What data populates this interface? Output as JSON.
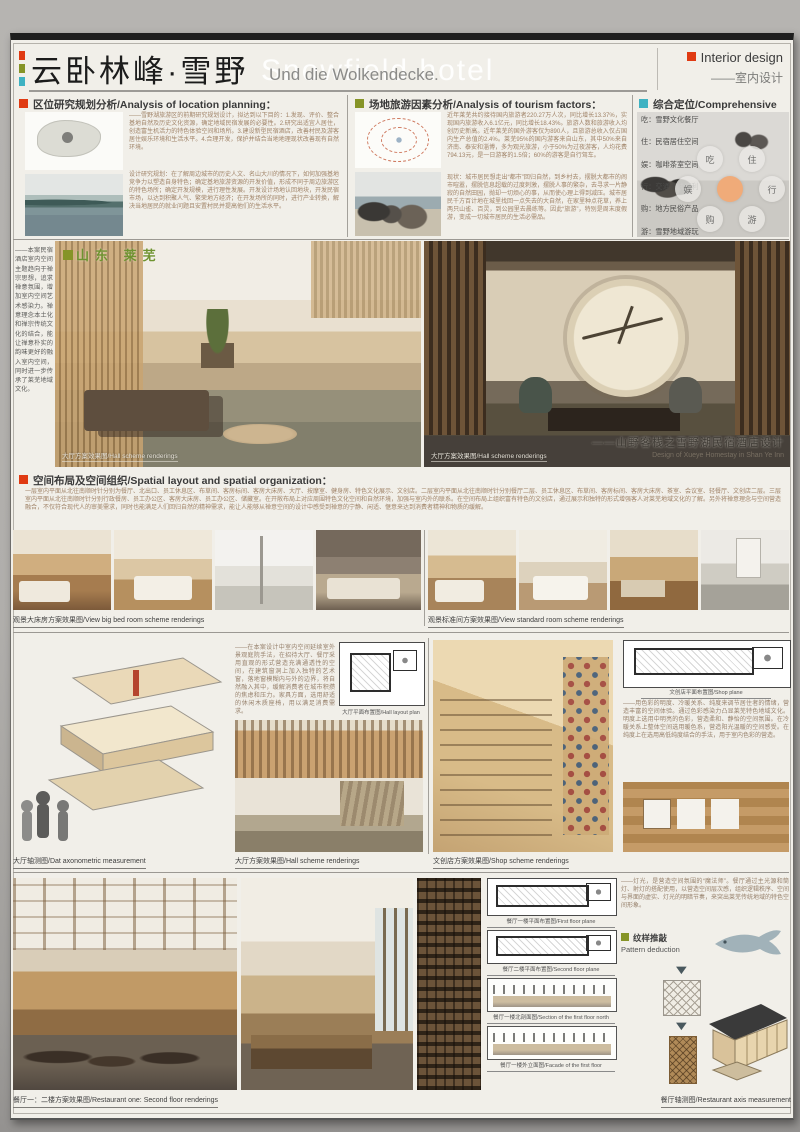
{
  "header": {
    "title_cn": "云卧林峰·雪野",
    "title_ghost": "Snowfield hotel",
    "title_de": "Und die Wolkendecke.",
    "tag_en": "Interior design",
    "tag_cn": "——室内设计"
  },
  "accent_colors": {
    "red": "#e03a12",
    "olive": "#869427",
    "cyan": "#3fb2c2",
    "orange": "#f0ab79"
  },
  "sec_location": {
    "title": "区位研究规划分析/Analysis of location planning：",
    "p1": "——雪野湖旅游区的前期研究规划设计，拟达到以下目的：1.发现、评价、整合基地自然及历史文化资源，确定地域民宿发展的必要性。2.研究出适宜人居住，创造富生机活力的特色体验空间和场所。3.建设新型民宿酒店，改善村民及游客居住娱乐环境和生活水平。4.合理开发，保护并结合当地地理现状改善现有自然环境。",
    "p2": "设计研究规划：在了解周边城市的历史人文、名山大川的情况下，如何加强基地竞争力以塑造自身特色；确定基地旅游资源的开发价值，形成不同于周边旅游区的特色场所；确定开发规模，进行理性发展。开发设计场地认回地块，开发民宿市场，以达到积聚人气、繁荣地方经济；在开发场所的同时，进行产业转换，解决当地居民的就业问题且安置村民并提高他们的生活水平。"
  },
  "sec_tourism": {
    "title": "场地旅游因素分析/Analysis of tourism factors：",
    "p1": "近年莱芜共约接待国内旅游者220.27万人次，同比增长13.37%，实现国内旅游收入6.1亿元，同比增长18.43%。旅游人数和旅游收入均创历史新高。近年莱芜的国外游客仅为890人，且旅游总收入仅占国内生产总值的2.4%。莱芜95%的国内游客来自山东，其中50%来自济南、泰安和淄博，多为观光旅游，小于50%为过夜游客，人均花费794.13元，是一日游客的1.5倍；60%的游客是自行驾车。",
    "p2": "现状：城市居民想走出“都市”回归自然，到乡村去，摆脱大都市的闹市喧嚣，摆脱信息超载的过度刺激，摆脱人事的繁杂，去寻求一片静寂的自然田园，抛却一切烦心的事，从而使心理上得到减压。城市居民千方百计地在城里找回一点失去的大自然，在家里种点花草，养上两只山雀、百灵，到公园里去晨练等。因此“旅游”，特别是周末度假游，变成一切城市居民的生活必需品。"
  },
  "sec_comprehensive": {
    "title": "综合定位/Comprehensive",
    "items": [
      "吃：雪野文化餐厅",
      "住：民宿居住空间",
      "娱：咖啡茶室空间",
      "行：交通流线便利",
      "购：地方民俗产品",
      "游：雪野地域游玩"
    ],
    "circles": [
      "吃",
      "住",
      "娱",
      "行",
      "购",
      "游"
    ]
  },
  "hero": {
    "side_note": "——本案民宿酒店室内空间主题趋向于禅宗思想，追求禅意氛围，增加室内空间艺术感染力。禅意理念本土化和禅宗传统文化的结合，能让禅意朴实的韵味更好的融入室内空间，同时进一步传承了莱芜地域文化。",
    "region_label": "山东 莱芜",
    "caption_left": "大厅方案效果图/Hall scheme renderings",
    "caption_right": "大厅方案效果图/Hall scheme renderings",
    "project_cn": "——山野客栈之雪野湖民宿酒店设计",
    "project_en": "Design of Xueye Homestay in Shan Ye Inn"
  },
  "sec_spatial": {
    "title": "空间布局及空间组织/Spatial layout and spatial organization：",
    "p1": "一层室内平面从北往南顺时针分别为餐厅、北出口、员工休息区、布草间、客房标间、客房大床房、大厅、按摩室、健身房、特色文化展示、文创店。二层室内平面从北往南顺时针分别餐厅二层、员工休息区、布草间、客房标间、客房大床房、茶室、会议室、轻餐厅、文创店二层。三层室内平面从北往南顺时针分别行政餐房、员工办公区、客房大床房、员工办公区、储藏室。在开敞布局上对应周围特色文化空间和自然环境，加强与室内外的联系。在空间布局上组织富有特色的文创店，通过展示和独特的形式增强客人对莱芜地域文化的了解。另外将禅意理念与空间营造融合，不仅符合现代人的审美需求，同时也能满足人们回归自然的精神需求，能让人能够从禅意空间的设计中感受到禅意的宁静、闲适、惬意来达到消费者精神和物质的缓解。"
  },
  "rooms": {
    "caption_left": "观景大床房方案效果图/View big bed room scheme renderings",
    "caption_right": "观景标准间方案效果图/View standard room scheme renderings"
  },
  "row3": {
    "axon_caption": "大厅轴测图/Dat axonometric measurement",
    "mid_text": "——在本案设计中室内空间延续室外景观庭院手法，在招待大厅、餐厅采用直观的形式营造充满通透性的空间，在建筑窗洞上加入独特的艺术窗，落地窗模糊内与外的边界，将自然融入其中，缓解消费者在城市积攒的焦虑和压力。家具方面，选用舒适的休闲木质座椅，用以满足消费需求。",
    "hall_plan_caption": "大厅平面布置图/Hall layout plan",
    "hall_caption": "大厅方案效果图/Hall scheme renderings",
    "shop_caption": "文创店方案效果图/Shop scheme renderings",
    "shop_plan_caption": "文创店平面布置图/Shop plane",
    "color_text": "——用色彩的明度、冷暖关系、纯度来调节居住者的情绪，营造丰富的空间体验。通过色彩感染力凸显莱芜特色地域文化。明度上选用中明亮的色彩，营造柔和、静怡的空间氛围。在冷暖关系上整体空间选用暖色系，营造阳光温暖的空间感受。在纯度上在选用高低纯度结合的手法，用于室内色彩的营造。"
  },
  "row4": {
    "light_text": "——灯光，是营造空间氛围的“魔法师”。餐厅通过主光源和筒灯、射灯的搭配使用，以营造空间层次感，组织逻辑秩序、空间与界面的虚实、灯光的明暗节奏，来突出莱芜传统地域的特色空间形象。",
    "pattern_title": "纹样推敲",
    "pattern_subtitle": "Pattern deduction",
    "plan1_caption": "餐厅一楼平面布置图/First floor plane",
    "plan2_caption": "餐厅二楼平面布置图/Second floor plane",
    "section_caption": "餐厅一楼北剖面图/Section of the first floor north",
    "facade_caption": "餐厅一楼外立面图/Facade of the first floor",
    "renders_caption": "餐厅一：二楼方案效果图/Restaurant one: Second floor renderings",
    "axon_caption": "餐厅轴测图/Restaurant axis measurement"
  }
}
